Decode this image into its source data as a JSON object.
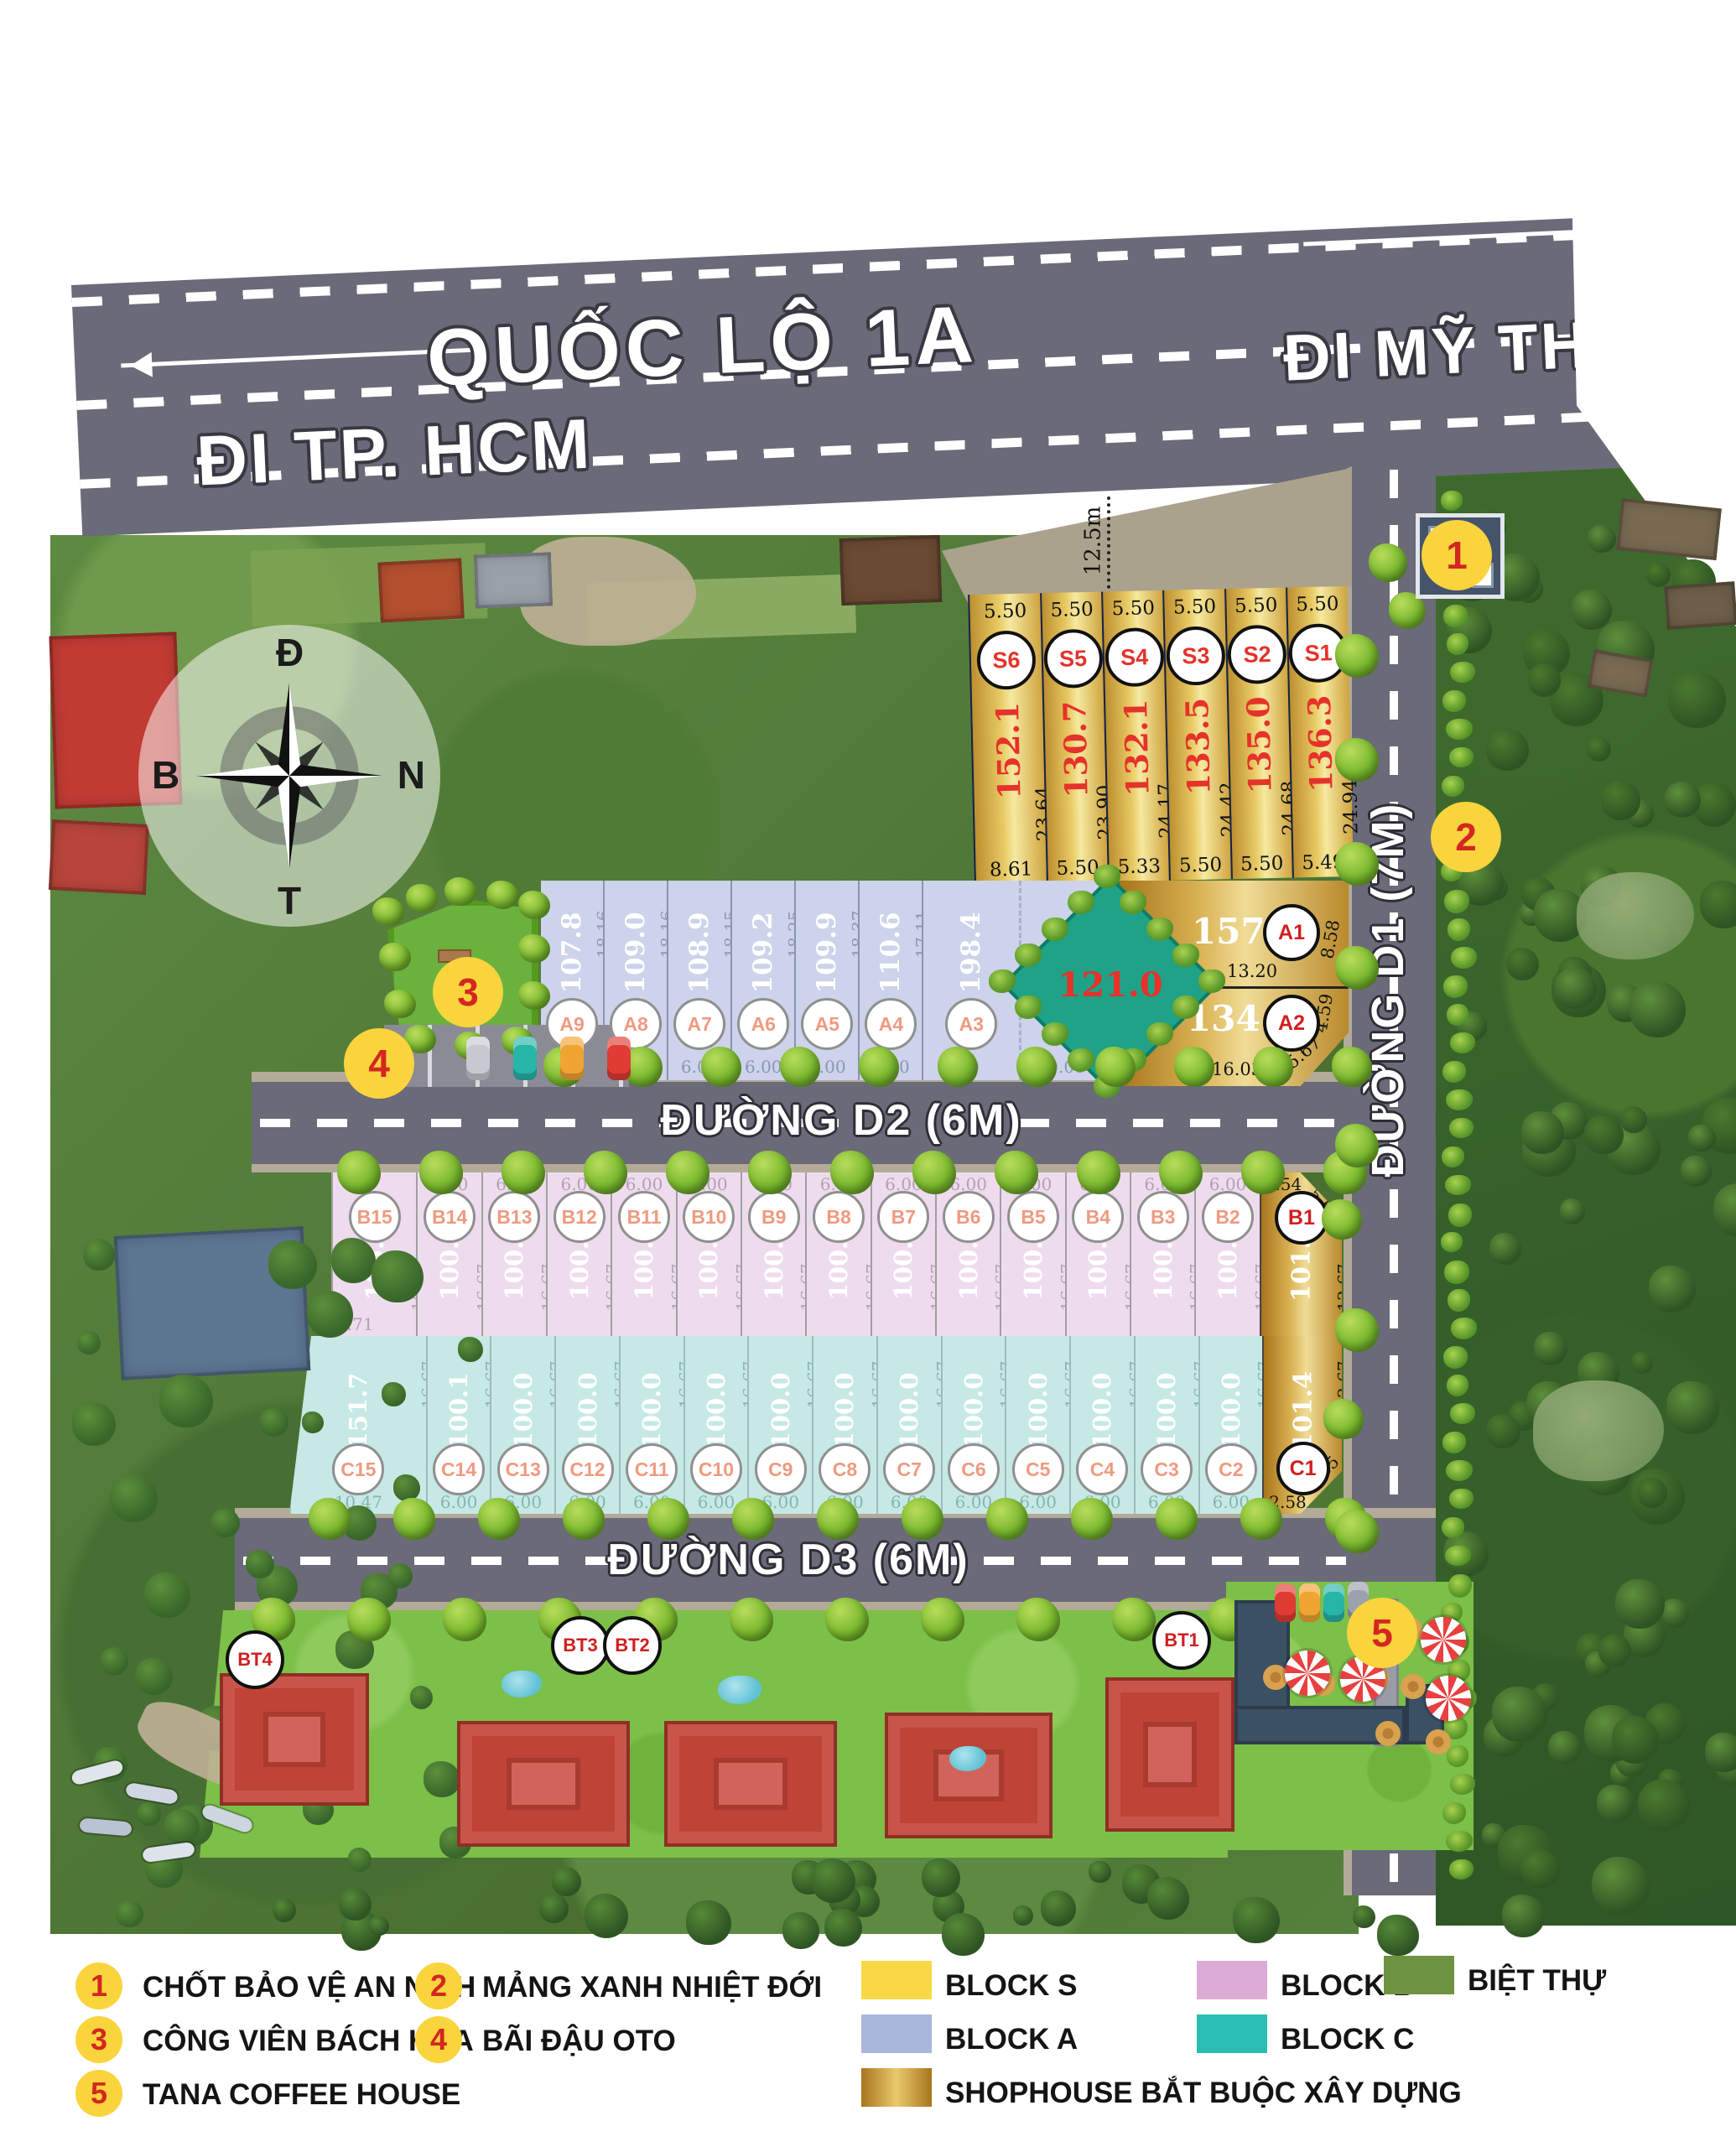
{
  "roads": {
    "highway_name": "QUỐC LỘ 1A",
    "dir_left": "ĐI TP. HCM",
    "dir_right": "ĐI MỸ THO",
    "d1": "ĐƯỜNG D1 (7M)",
    "d2": "ĐƯỜNG D2 (6M)",
    "d3": "ĐƯỜNG D3 (6M)",
    "setback": "12.5m"
  },
  "compass": {
    "top": "Đ",
    "right": "N",
    "bottom": "T",
    "left": "B"
  },
  "blocks": {
    "s": {
      "plots": [
        {
          "id": "S6",
          "area": "152.1",
          "top": "5.50",
          "side": "23.64",
          "bottom": "8.61",
          "shophouse": true
        },
        {
          "id": "S5",
          "area": "130.7",
          "top": "5.50",
          "side": "23.90",
          "bottom": "5.50",
          "shophouse": true
        },
        {
          "id": "S4",
          "area": "132.1",
          "top": "5.50",
          "side": "24.17",
          "bottom": "5.33",
          "shophouse": true
        },
        {
          "id": "S3",
          "area": "133.5",
          "top": "5.50",
          "side": "24.42",
          "bottom": "5.50",
          "shophouse": true
        },
        {
          "id": "S2",
          "area": "135.0",
          "top": "5.50",
          "side": "24.68",
          "bottom": "5.50",
          "shophouse": true
        },
        {
          "id": "S1",
          "area": "136.3",
          "top": "5.50",
          "side": "24.94",
          "bottom": "5.49",
          "shophouse": true
        }
      ]
    },
    "a": {
      "plots": [
        {
          "id": "A9",
          "area": "107.8",
          "side": "18.16",
          "bottom": "6.00"
        },
        {
          "id": "A8",
          "area": "109.0",
          "side": "18.16",
          "bottom": "6.00"
        },
        {
          "id": "A7",
          "area": "108.9",
          "side": "18.15",
          "bottom": "6.00"
        },
        {
          "id": "A6",
          "area": "109.2",
          "side": "18.25",
          "bottom": "6.00"
        },
        {
          "id": "A5",
          "area": "109.9",
          "side": "18.37",
          "bottom": "6.00"
        },
        {
          "id": "A4",
          "area": "110.6",
          "side": "17.11",
          "bottom": "6.00"
        },
        {
          "id": "A3",
          "area": "198.4",
          "bottom": "6.00",
          "bottom2": "10.06"
        }
      ]
    },
    "a1": {
      "id": "A1",
      "area": "157.5",
      "side": "8.58",
      "divider": "13.20",
      "shophouse": true
    },
    "a2": {
      "id": "A2",
      "area": "134.9",
      "side": "4.59",
      "diag": "5.67",
      "bottom": "16.03",
      "shophouse": true
    },
    "b": {
      "plots": [
        {
          "id": "B15",
          "area": "105.6",
          "side": "16.67",
          "extra": "7.71"
        },
        {
          "id": "B14",
          "area": "100.0",
          "top": "6.00",
          "side": "16.67"
        },
        {
          "id": "B13",
          "area": "100.0",
          "top": "6.00",
          "side": "16.67"
        },
        {
          "id": "B12",
          "area": "100.0",
          "top": "6.00",
          "side": "16.67"
        },
        {
          "id": "B11",
          "area": "100.0",
          "top": "6.00",
          "side": "16.67"
        },
        {
          "id": "B10",
          "area": "100.0",
          "top": "6.00",
          "side": "16.67"
        },
        {
          "id": "B9",
          "area": "100.0",
          "top": "6.00",
          "side": "16.67"
        },
        {
          "id": "B8",
          "area": "100.0",
          "top": "6.00",
          "side": "16.67"
        },
        {
          "id": "B7",
          "area": "100.0",
          "top": "6.00",
          "side": "16.67"
        },
        {
          "id": "B6",
          "area": "100.0",
          "top": "6.00",
          "side": "16.67"
        },
        {
          "id": "B5",
          "area": "100.0",
          "top": "6.00",
          "side": "16.67"
        },
        {
          "id": "B4",
          "area": "100.0",
          "top": "6.00",
          "side": "16.67"
        },
        {
          "id": "B3",
          "area": "100.0",
          "top": "6.00",
          "side": "16.67"
        },
        {
          "id": "B2",
          "area": "100.0",
          "top": "6.00",
          "side": "16.67"
        },
        {
          "id": "B1",
          "area": "101.1",
          "top": "2.54",
          "diag": "5.65",
          "side": "12.67",
          "shophouse": true
        }
      ]
    },
    "c": {
      "plots": [
        {
          "id": "C15",
          "area": "151.7",
          "side": "16.67",
          "bottom": "10.47"
        },
        {
          "id": "C14",
          "area": "100.1",
          "side": "16.67",
          "bottom": "6.00"
        },
        {
          "id": "C13",
          "area": "100.0",
          "side": "16.67",
          "bottom": "6.00"
        },
        {
          "id": "C12",
          "area": "100.0",
          "side": "16.67",
          "bottom": "6.00"
        },
        {
          "id": "C11",
          "area": "100.0",
          "side": "16.67",
          "bottom": "6.00"
        },
        {
          "id": "C10",
          "area": "100.0",
          "side": "16.67",
          "bottom": "6.00"
        },
        {
          "id": "C9",
          "area": "100.0",
          "side": "16.67",
          "bottom": "6.00"
        },
        {
          "id": "C8",
          "area": "100.0",
          "side": "16.67",
          "bottom": "6.00"
        },
        {
          "id": "C7",
          "area": "100.0",
          "side": "16.67",
          "bottom": "6.00"
        },
        {
          "id": "C6",
          "area": "100.0",
          "side": "16.67",
          "bottom": "6.00"
        },
        {
          "id": "C5",
          "area": "100.0",
          "side": "16.67",
          "bottom": "6.00"
        },
        {
          "id": "C4",
          "area": "100.0",
          "side": "16.67",
          "bottom": "6.00"
        },
        {
          "id": "C3",
          "area": "100.0",
          "side": "16.67",
          "bottom": "6.00"
        },
        {
          "id": "C2",
          "area": "100.0",
          "side": "16.67",
          "bottom": "6.00"
        },
        {
          "id": "C1",
          "area": "101.4",
          "side": "12.67",
          "diag": "5.65",
          "bottom": "2.58",
          "shophouse": true
        }
      ]
    },
    "green_diamond": {
      "area": "121.0"
    }
  },
  "villas": {
    "labels": [
      "BT4",
      "BT3",
      "BT2",
      "BT1"
    ]
  },
  "markers": [
    {
      "n": "1",
      "label": "CHỐT BẢO VỆ AN NINH"
    },
    {
      "n": "2",
      "label": "MẢNG XANH NHIỆT ĐỚI"
    },
    {
      "n": "3",
      "label": "CÔNG VIÊN BÁCH HOA"
    },
    {
      "n": "4",
      "label": "BÃI ĐẬU OTO"
    },
    {
      "n": "5",
      "label": "TANA COFFEE HOUSE"
    }
  ],
  "legend": {
    "block_s": "BLOCK S",
    "block_a": "BLOCK A",
    "block_b": "BLOCK B",
    "block_c": "BLOCK C",
    "villa": "BIỆT THỰ",
    "shophouse": "SHOPHOUSE BẮT BUỘC XÂY DỰNG",
    "colors": {
      "block_s": "#f8d847",
      "block_a": "#a9b7dd",
      "block_b": "#dcabd5",
      "block_c": "#2abdb2",
      "villa": "#6d9340",
      "shophouse_gold": "#c9973a"
    }
  }
}
